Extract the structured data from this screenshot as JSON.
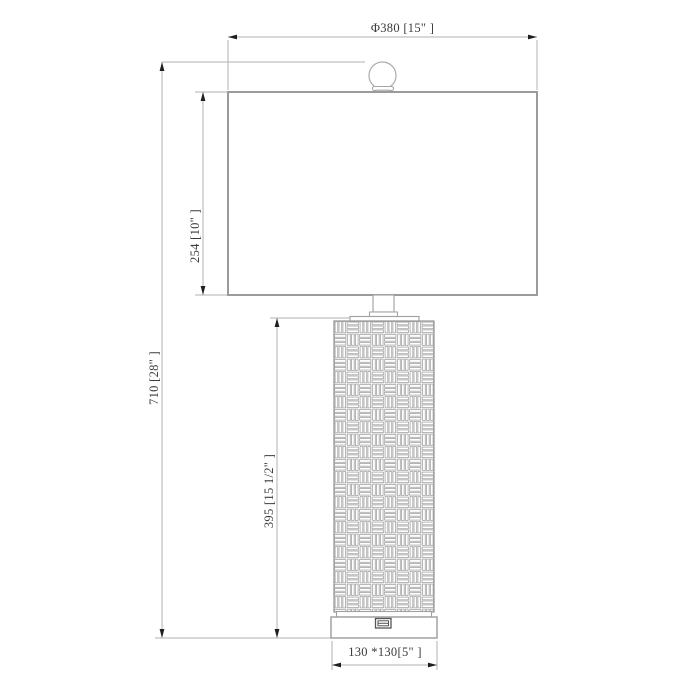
{
  "drawing_type": "table-lamp dimension drawing",
  "colors": {
    "background": "#ffffff",
    "outline": "#9b9b9b",
    "dimension_line": "#b2b2b2",
    "arrow": "#1f1f1f",
    "text": "#3c3c3c",
    "weave_line": "#a8a8a8",
    "usb_outline": "#555555"
  },
  "dimensions": {
    "shade_diameter": {
      "label": "Φ380 [15\" ]",
      "value_mm": 380,
      "value_in": "15\""
    },
    "total_height": {
      "label": "710 [28\" ]",
      "value_mm": 710,
      "value_in": "28\""
    },
    "shade_height": {
      "label": "254 [10\" ]",
      "value_mm": 254,
      "value_in": "10\""
    },
    "body_height": {
      "label": "395 [15 1/2\" ]",
      "value_mm": 395,
      "value_in": "15 1/2\""
    },
    "base_size": {
      "label": "130 *130[5\" ]",
      "value_mm": "130x130",
      "value_in": "5\""
    }
  }
}
